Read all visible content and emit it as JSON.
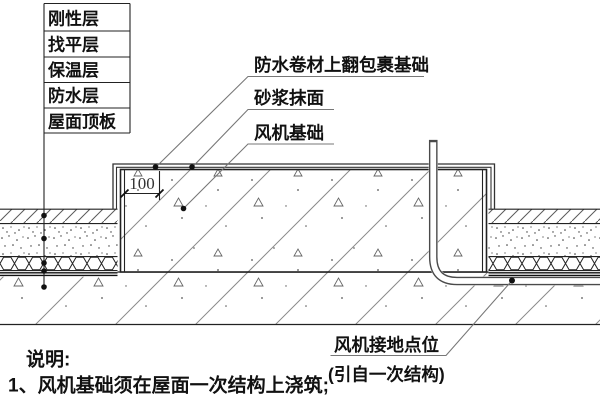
{
  "drawing": {
    "layer_labels": [
      "刚性层",
      "找平层",
      "保温层",
      "防水层",
      "屋面顶板"
    ],
    "callouts": {
      "membrane": "防水卷材上翻包裹基础",
      "mortar": "砂浆抹面",
      "foundation": "风机基础",
      "ground_line1": "风机接地点位",
      "ground_line2": "(引自一次结构)"
    },
    "dimension_value": "100",
    "notes": {
      "title": "说明:",
      "item1": "1、风机基础须在屋面一次结构上浇筑;"
    },
    "colors": {
      "line": "#222222",
      "hatch": "#8a8a8a",
      "leader": "#777777",
      "background": "#ffffff"
    }
  }
}
